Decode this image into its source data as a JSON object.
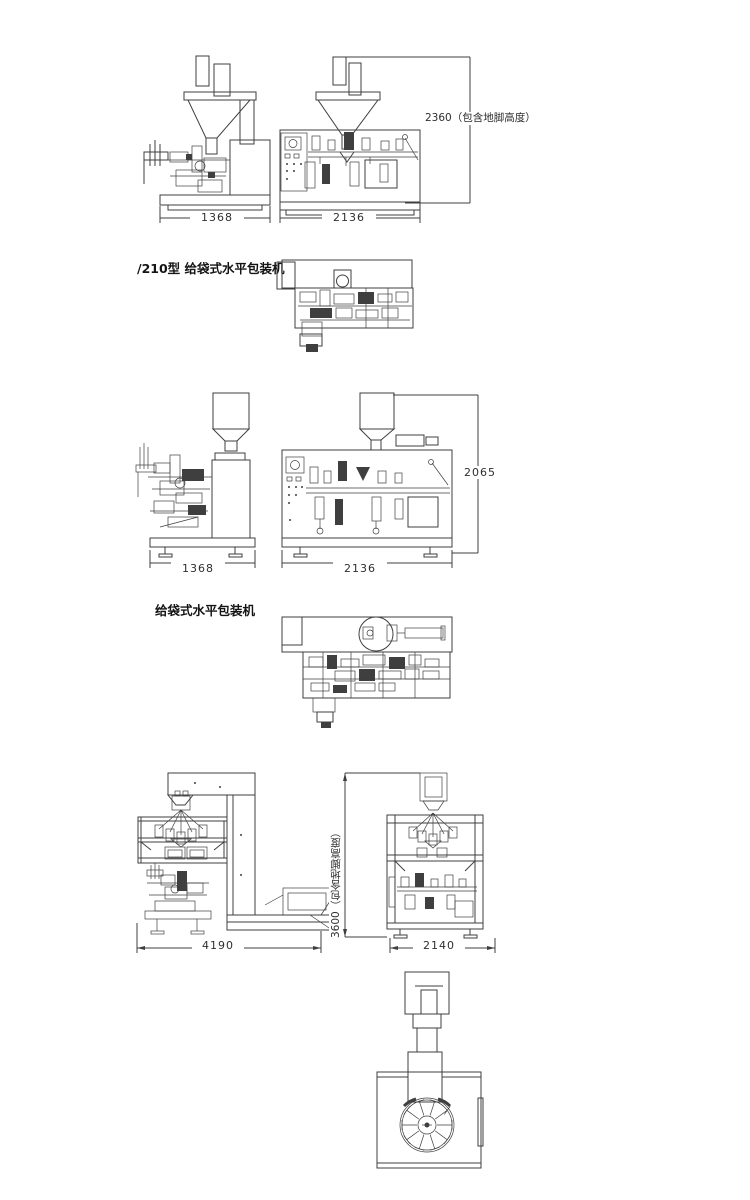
{
  "background": "#ffffff",
  "line_color": "#3f3f3f",
  "machines": {
    "top": {
      "label": "/210型 给袋式水平包装机",
      "side_width_dim": "1368",
      "front_width_dim": "2136",
      "overall_height_dim": "2360（包含地脚高度）"
    },
    "middle": {
      "label": "给袋式水平包装机",
      "side_width_dim": "1368",
      "front_width_dim": "2136",
      "overall_height_dim": "2065"
    },
    "bottom": {
      "system_width_dim": "4190",
      "front_width_dim": "2140",
      "overall_height_dim": "3600（包含地脚高度）"
    }
  }
}
